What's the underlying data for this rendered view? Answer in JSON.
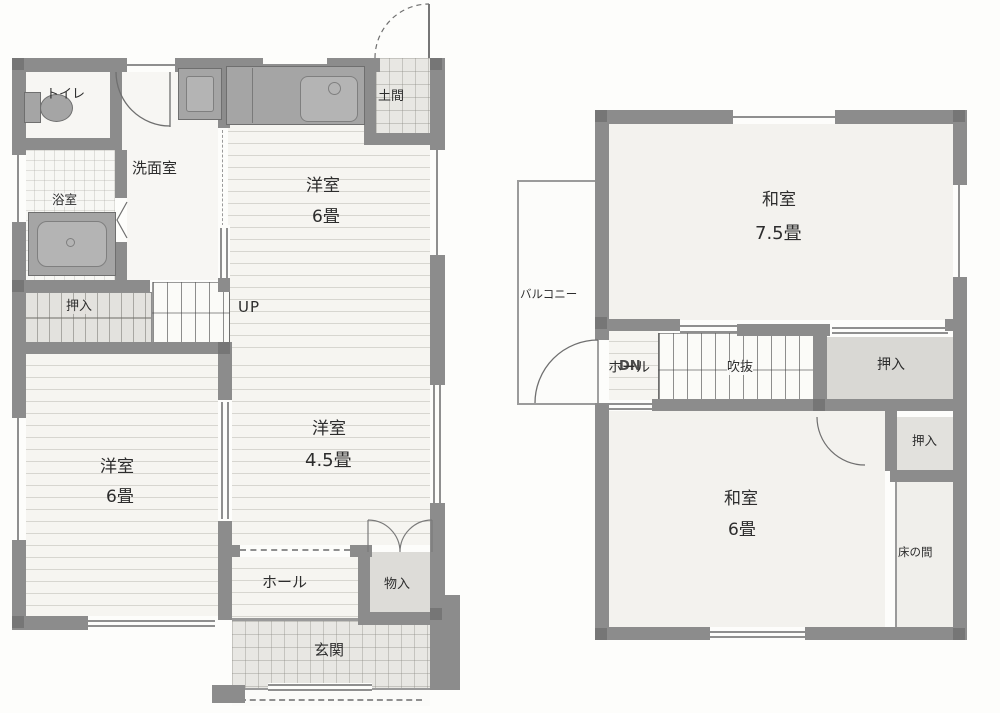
{
  "floor1": {
    "toilet": "トイレ",
    "bath": "浴室",
    "washroom": "洗面室",
    "doma": "土間",
    "room_top": "洋室",
    "room_top_size": "6畳",
    "closet": "押入",
    "stairs": "UP",
    "room_left": "洋室",
    "room_left_size": "6畳",
    "room_mid": "洋室",
    "room_mid_size": "4.5畳",
    "hall": "ホール",
    "storage": "物入",
    "entrance": "玄関"
  },
  "floor2": {
    "room_top": "和室",
    "room_top_size": "7.5畳",
    "balcony": "バルコニー",
    "hall": "ホール",
    "stairs": "DN",
    "void": "吹抜",
    "closet_upper": "押入",
    "closet_lower": "押入",
    "room_bottom": "和室",
    "room_bottom_size": "6畳",
    "tokonoma": "床の間"
  },
  "colors": {
    "wall": "#8c8c8c",
    "fixture": "#a5a5a5",
    "floor": "#f6f5f1",
    "tatami": "#f3f2ee",
    "tile": "#e8e7e3",
    "closet": "#dddcd8",
    "text": "#2d2d2d"
  }
}
